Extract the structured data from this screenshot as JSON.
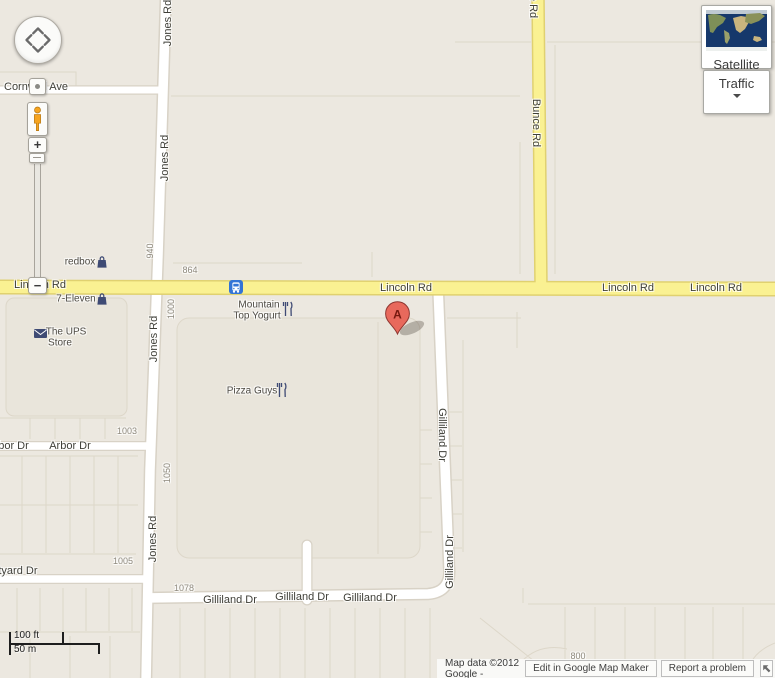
{
  "map": {
    "street_labels": [
      "Cornwall Ave",
      "Lincoln Rd",
      "Lincoln Rd",
      "Lincoln Rd",
      "Lincoln Rd",
      "Jones Rd",
      "Jones Rd",
      "Jones Rd",
      "Jones Rd",
      "Bunce Rd",
      "Bunce Rd",
      "Arbor Dr",
      "Arbor Dr",
      "Courtyard Dr",
      "Gilliland Dr",
      "Gilliland Dr",
      "Gilliland Dr",
      "Gilliland Dr",
      "Gilliland Dr"
    ],
    "address_numbers": [
      "864",
      "940",
      "1000",
      "1003",
      "1050",
      "1005",
      "1078",
      "800"
    ],
    "pois": {
      "redbox": "redbox",
      "seven_eleven": "7-Eleven",
      "ups_line1": "The UPS",
      "ups_line2": "Store",
      "yogurt_line1": "Mountain",
      "yogurt_line2": "Top Yogurt",
      "pizza": "Pizza Guys"
    },
    "marker_label": "A"
  },
  "controls": {
    "satellite_label": "Satellite",
    "traffic_label": "Traffic",
    "zoom_in": "+",
    "zoom_out": "−"
  },
  "scale": {
    "feet": "100 ft",
    "meters": "50 m"
  },
  "attribution": {
    "map_data": "Map data ©2012 Google -",
    "edit_button": "Edit in Google Map Maker",
    "report_button": "Report a problem"
  },
  "icons": {
    "pan": "directional-pad",
    "recenter": "center-dot",
    "streetview_pegman": "orange-person",
    "satellite_thumbnail": "world-satellite-map",
    "traffic_expander": "chevron-down",
    "transit_stop": "blue-bus",
    "shopping": "shopping-bag",
    "post_office": "envelope",
    "restaurant": "fork-and-knife",
    "marker": "red-pin-A",
    "attribution_collapse": "arrow-up-left"
  },
  "colors": {
    "map_background": "#ECE8E0",
    "road_yellow": "#FAF192",
    "road_yellow_casing": "#E0D170",
    "road_white": "#FFFFFF",
    "road_casing": "#D8D2C6",
    "marker_red": "#E8695C",
    "transit_blue": "#3374D6",
    "poi_icon_navy": "#3E4A74"
  }
}
